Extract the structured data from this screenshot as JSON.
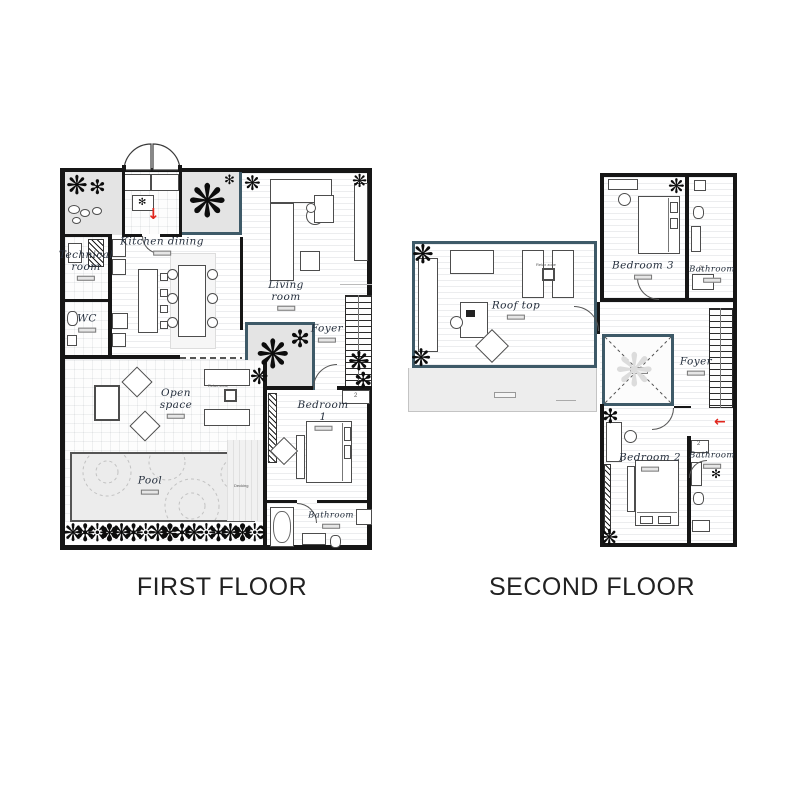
{
  "titles": {
    "first": "FIRST FLOOR",
    "second": "SECOND FLOOR"
  },
  "first_floor": {
    "rooms": {
      "kitchen_dining": "Kitchen dining",
      "technical_room": "Technical\nroom",
      "wc": "WC",
      "living_room": "Living\nroom",
      "foyer": "Foyer",
      "open_space": "Open\nspace",
      "pool": "Pool",
      "bedroom_1": "Bedroom 1",
      "bathroom": "Bathroom"
    }
  },
  "second_floor": {
    "rooms": {
      "roof_top": "Roof top",
      "bedroom_3": "Bedroom 3",
      "bathroom_3": "Bathroom",
      "foyer": "Foyer",
      "bedroom_2": "Bedroom 2",
      "bathroom_2": "Bathroom"
    }
  },
  "micro": {
    "relax_zone": "Relax zone",
    "decking": "Decking",
    "shower": "2"
  },
  "icons": {
    "plant": "❋",
    "plant_alt": "✻",
    "arrow_down": "↓",
    "arrow_left": "←",
    "hedge": "❋✻❊✽❋✻❊❋✽✻❋❊✻❋✽❊❋✻"
  },
  "colors": {
    "wall": "#161616",
    "accent_teal": "#3e5a68",
    "green_zone": "#e4e4e4",
    "pool": "#ececec",
    "arrow_red": "#e1261d",
    "label": "#26303e"
  }
}
